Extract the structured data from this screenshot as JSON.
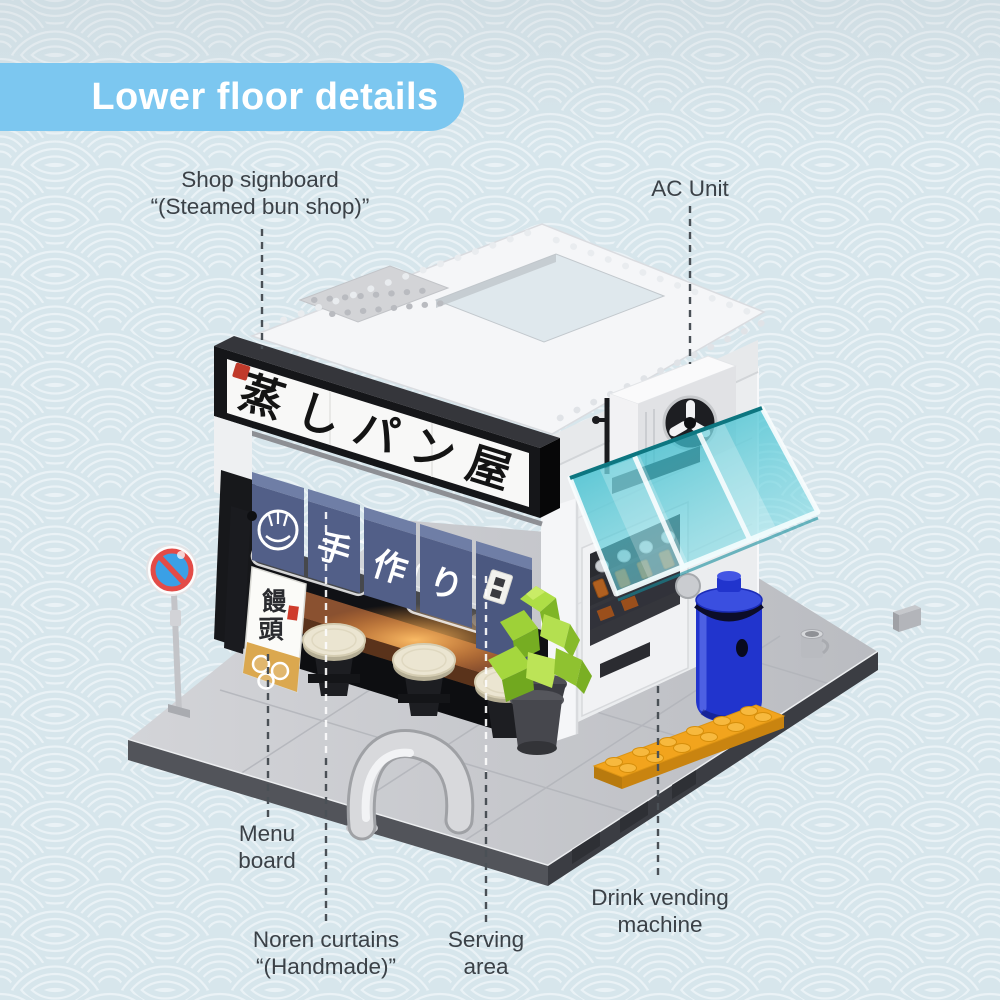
{
  "title_banner": {
    "text": "Lower floor details"
  },
  "callouts": {
    "shop_signboard": {
      "line1": "Shop signboard",
      "line2": "“(Steamed bun shop)”"
    },
    "ac_unit": {
      "line1": "AC Unit"
    },
    "menu_board": {
      "line1": "Menu",
      "line2": "board"
    },
    "noren_curtains": {
      "line1": "Noren curtains",
      "line2": "“(Handmade)”"
    },
    "serving_area": {
      "line1": "Serving",
      "line2": "area"
    },
    "drink_vending_machine": {
      "line1": "Drink vending",
      "line2": "machine"
    }
  },
  "model": {
    "signboard_chars": [
      "蒸",
      "し",
      "パ",
      "ン",
      "屋"
    ],
    "noren_chars": [
      "手",
      "作",
      "り"
    ],
    "menu_board_chars": [
      "饅",
      "頭"
    ],
    "colors": {
      "banner_blue": "#7cc7f0",
      "background_blue": "#dbe9ee",
      "label_text": "#3b4147",
      "signboard_black": "#151619",
      "noren_navy": "#525f88",
      "awning_teal": "#2fbecb",
      "tree_green": "#9ed138",
      "barrel_blue": "#2134cd",
      "plate_orange": "#f2a41d"
    }
  }
}
